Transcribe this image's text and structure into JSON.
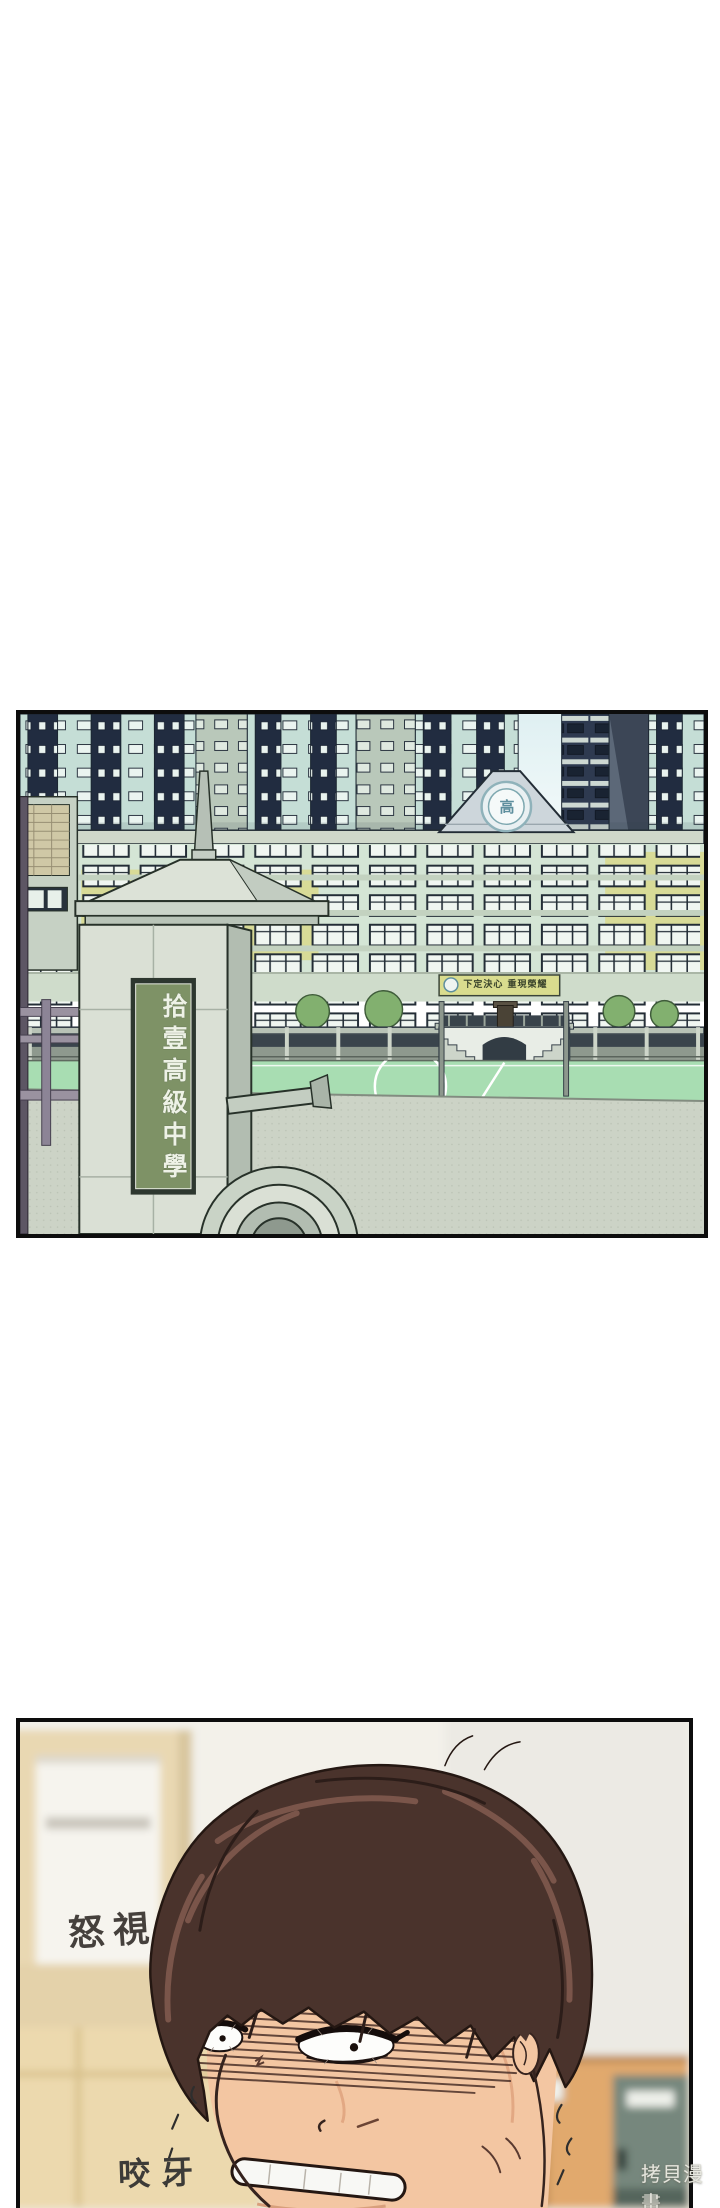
{
  "page": {
    "background": "#ffffff",
    "watermark_text": "拷貝漫畫"
  },
  "panel1": {
    "description": "exterior of school front gate with sports field and apartment towers",
    "sign_text": "拾壹高級中學",
    "banner_text": "下定決心 重現榮耀",
    "emblem_char": "高",
    "colors": {
      "tower_navy": "#212c40",
      "tower_mint": "#c5ded6",
      "school_wall": "#d4e5d5",
      "school_yellow": "#d8db97",
      "field_green": "#a8ddb2",
      "pavement": "#ccd3c6",
      "plaque_green": "#7e9266",
      "pillar_stone": "#dae0d5"
    }
  },
  "panel2": {
    "description": "close-up of angry boy glaring and gritting teeth",
    "sfx_glare": "怒視",
    "sfx_grit": "咬牙",
    "colors": {
      "hair": "#4a332c",
      "hair_highlight": "#7a554a",
      "skin": "#f3c6a2",
      "locker_orange": "#e1a96d",
      "wall_beige": "#e9d8b2"
    }
  }
}
